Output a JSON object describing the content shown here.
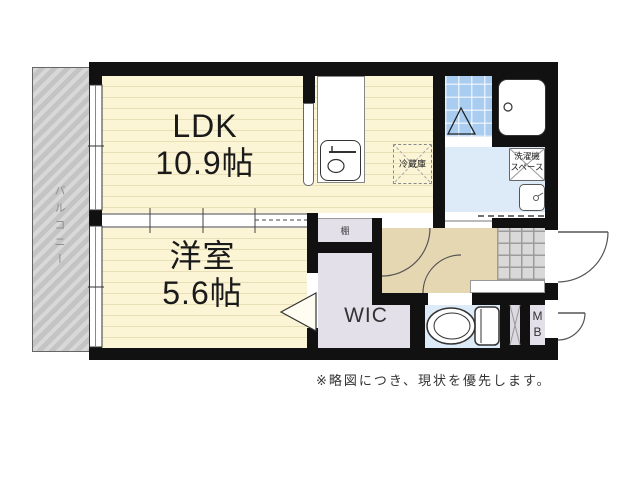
{
  "floorplan": {
    "rooms": {
      "ldk": {
        "name": "LDK",
        "size": "10.9帖"
      },
      "western_room": {
        "name": "洋室",
        "size": "5.6帖"
      },
      "wic": {
        "label": "WIC"
      },
      "balcony": {
        "label": "バルコニー"
      },
      "shelf": {
        "label": "棚"
      },
      "refrigerator": {
        "label": "冷蔵庫"
      },
      "washer_space": {
        "line1": "洗濯機",
        "line2": "スペース"
      },
      "meter_box": {
        "line1": "M",
        "line2": "B"
      }
    },
    "note": "※略図につき、現状を優先します。"
  },
  "colors": {
    "wall": "#111111",
    "room_cream": "#fbf4d5",
    "balcony_gray": "#cbcbcb",
    "hallway_tan": "#e6d7b3",
    "closet_lavender": "#e4e0ea",
    "wet_blue": "#dcebf7",
    "bath_tile": "#a9cdf1",
    "genkan_gray": "#d9d9d9"
  }
}
